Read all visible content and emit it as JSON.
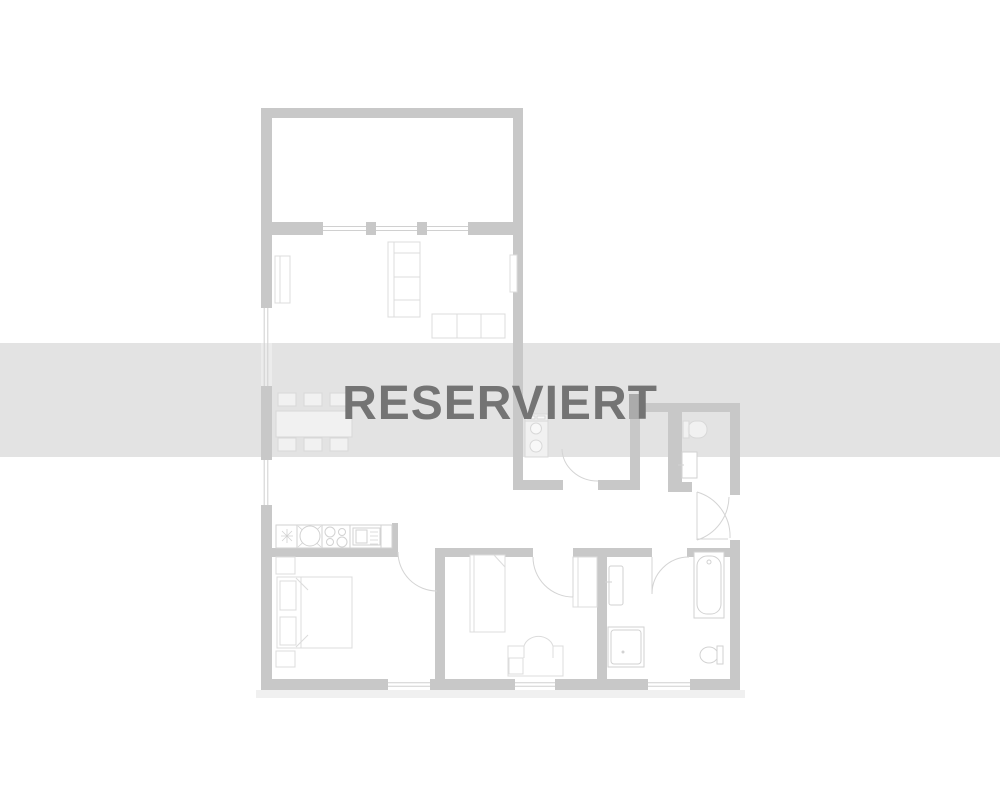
{
  "overlay": {
    "label": "RESERVIERT",
    "band_color": "#e3e3e3",
    "text_color": "#747474"
  },
  "colors": {
    "background": "#ffffff",
    "wall": "#c8c8c8",
    "furniture": "#dcdcdc",
    "fixture": "#d2d2d2",
    "furniture_faded": "#d8d8d8",
    "faded_fill": "rgba(255,255,255,0.5)",
    "window_line": "#d0d0d0",
    "door_arc": "#d4d4d4",
    "shaft": "#ababab",
    "shadow": "#f0f0f0"
  }
}
